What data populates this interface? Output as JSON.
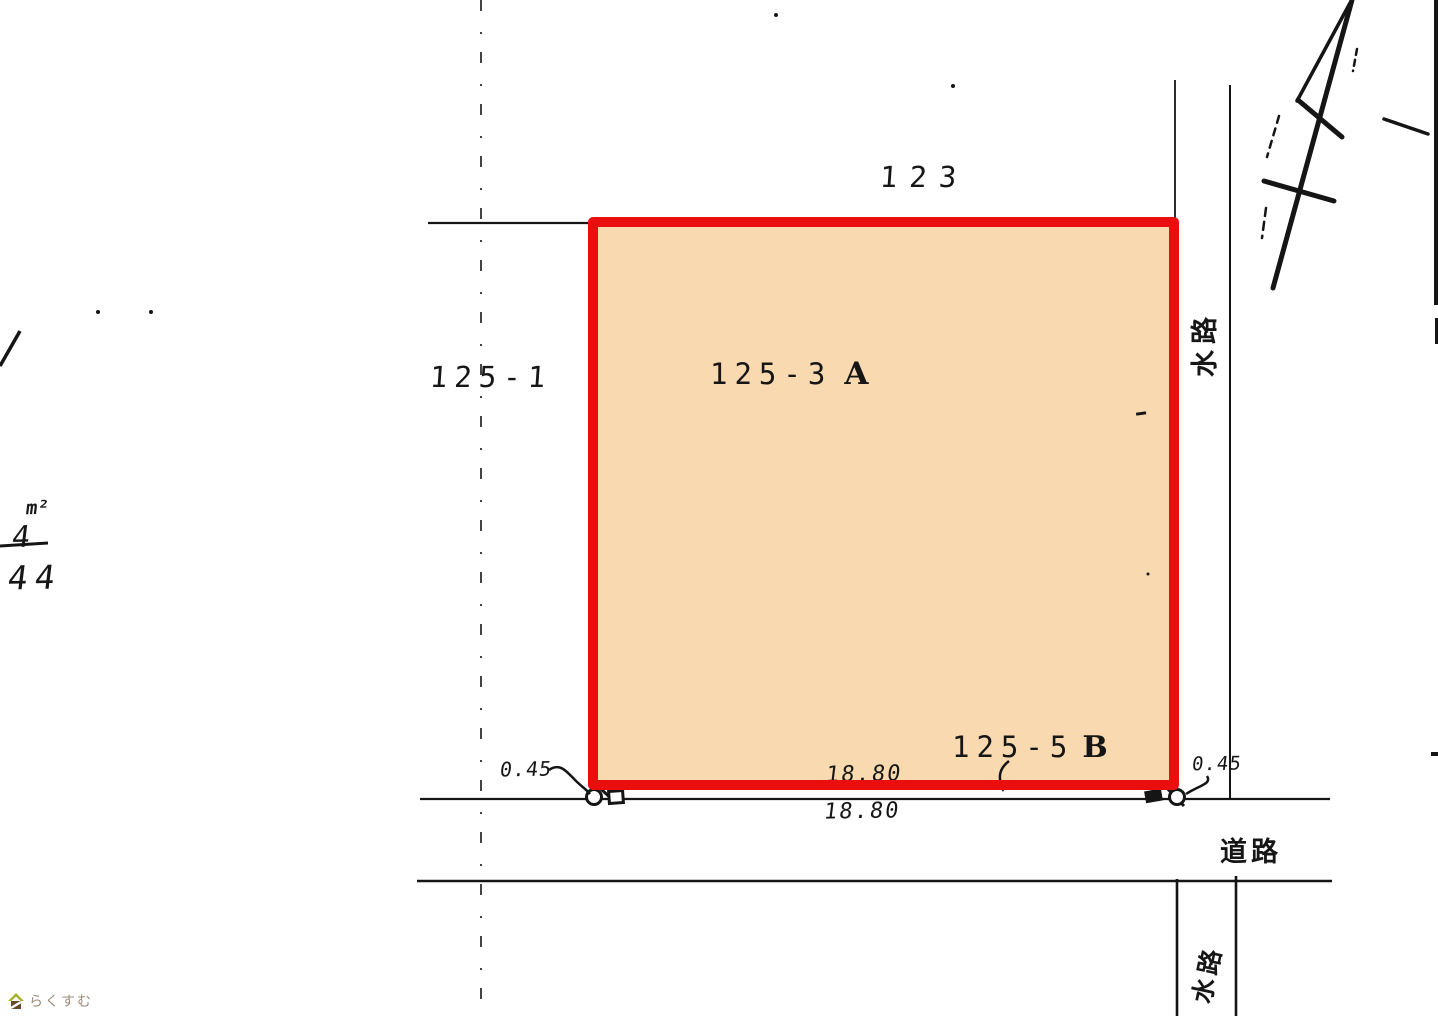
{
  "colors": {
    "parcel-fill": "#F9D9AF",
    "parcel-border": "#EB0E0E",
    "ink": "#151515",
    "watermark-text": "#9B8C7B",
    "house-roof": "#A9B22D",
    "house-body": "#6B4527"
  },
  "parcels": {
    "north": {
      "label": "123"
    },
    "west": {
      "label": "125-1"
    },
    "main": {
      "label": "125-3",
      "suffix": "A"
    },
    "strip": {
      "label": "125-5",
      "suffix": "B"
    }
  },
  "features": {
    "waterway-east": "水路",
    "waterway-south": "水路",
    "road": "道路"
  },
  "measurements": {
    "offset-west": "0.45",
    "offset-east": "0.45",
    "frontage-upper": "18.80",
    "frontage-lower": "18.80"
  },
  "handwriting": {
    "unit": "m²",
    "figure-a": "4",
    "figure-b": "44"
  },
  "watermark": {
    "brand": "らくすむ"
  }
}
